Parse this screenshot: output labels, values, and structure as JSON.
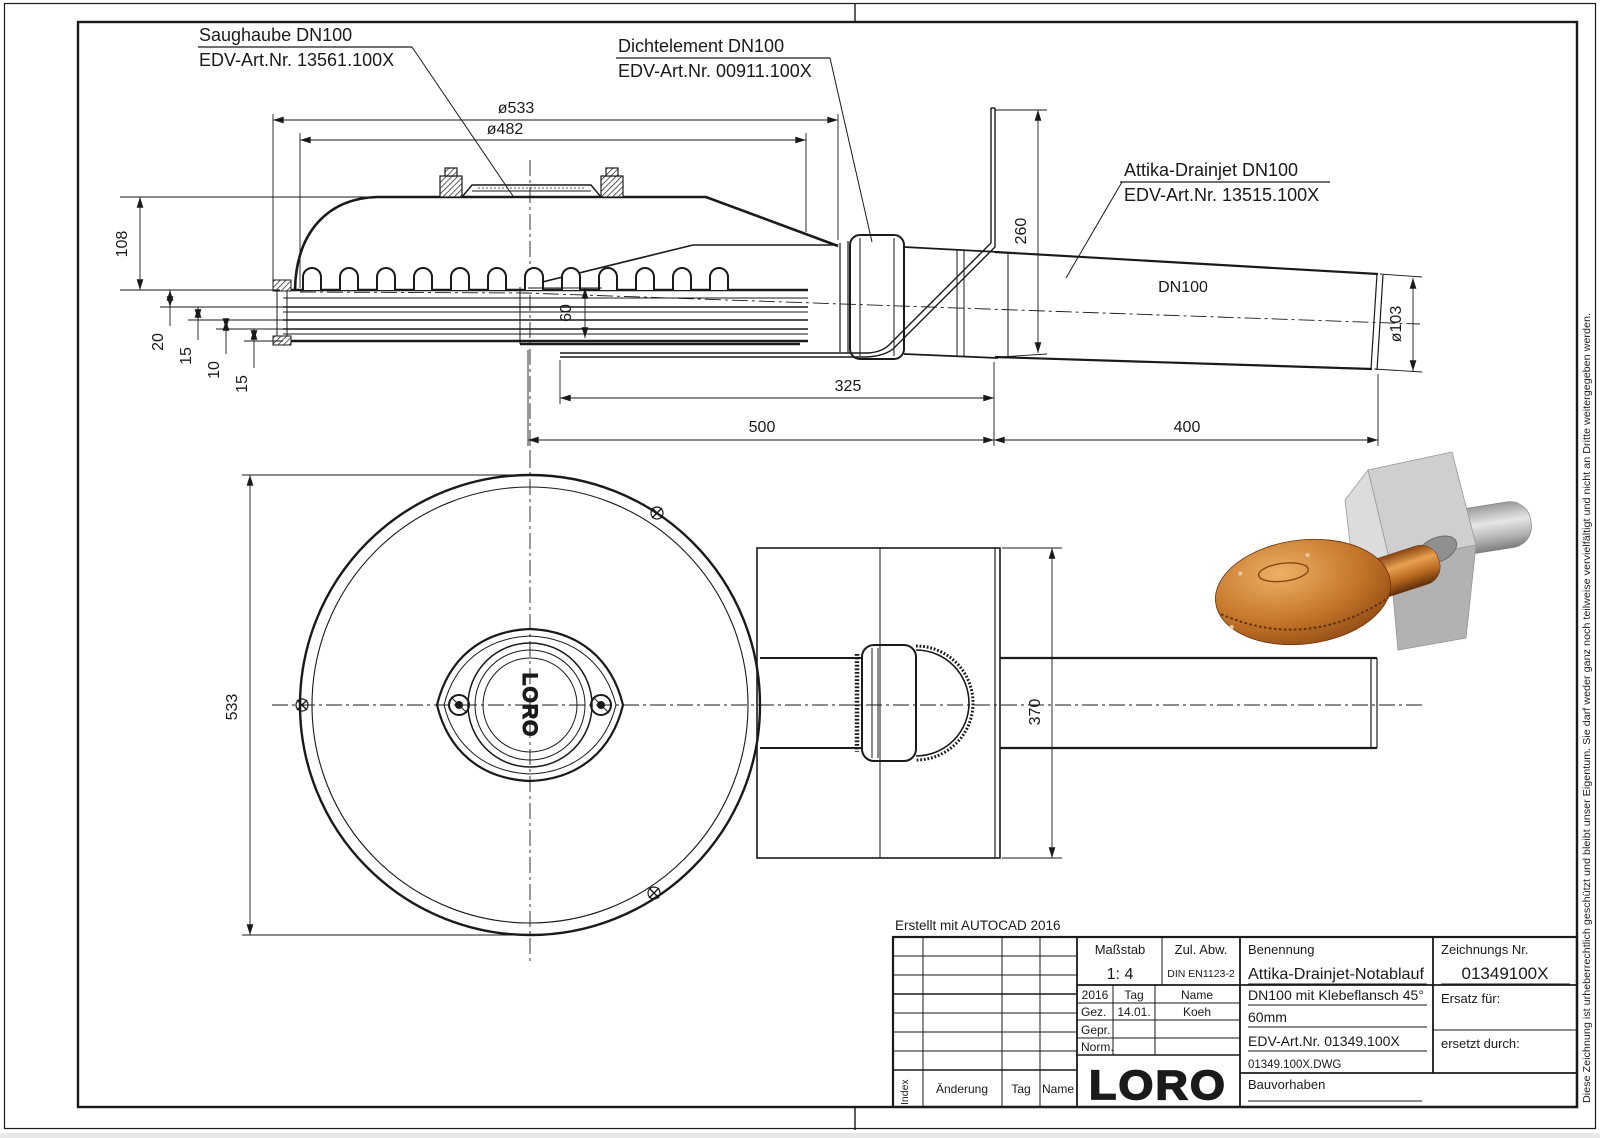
{
  "part_labels": {
    "saughaube": {
      "line1": "Saughaube DN100",
      "line2": "EDV-Art.Nr. 13561.100X"
    },
    "dichtelement": {
      "line1": "Dichtelement DN100",
      "line2": "EDV-Art.Nr. 00911.100X"
    },
    "attika": {
      "line1": "Attika-Drainjet DN100",
      "line2": "EDV-Art.Nr. 13515.100X"
    }
  },
  "side_view": {
    "pipe_label": "DN100",
    "dim_dia_outer": "ø533",
    "dim_dia_inner": "ø482",
    "dim_hood_height": "108",
    "dim_plate_20": "20",
    "dim_plate_15a": "15",
    "dim_plate_10": "10",
    "dim_plate_15b": "15",
    "dim_duct_height": "60",
    "dim_flange_height": "260",
    "dim_len_325": "325",
    "dim_len_500": "500",
    "dim_len_400": "400",
    "dim_pipe_dia": "ø103"
  },
  "plan_view": {
    "dim_dia": "533",
    "dim_plate_height": "370",
    "hub_logo": "LORO"
  },
  "notes": {
    "created_with": "Erstellt mit AUTOCAD 2016",
    "copyright": "Diese Zeichnung ist urheberrechtlich geschützt und bleibt unser Eigentum. Sie darf weder ganz noch teilweise vervielfältigt und nicht an Dritte weitergegeben werden."
  },
  "title_block": {
    "masstab_label": "Maßstab",
    "masstab_value": "1: 4",
    "zul_abw_label": "Zul. Abw.",
    "zul_abw_value": "DIN EN1123-2",
    "benennung_label": "Benennung",
    "benennung_value": "Attika-Drainjet-Notablauf",
    "zeichnungs_nr_label": "Zeichnungs Nr.",
    "zeichnungs_nr_value": "01349100X",
    "approval_year": "2016",
    "approval_col_tag": "Tag",
    "approval_col_name": "Name",
    "gez_label": "Gez.",
    "gez_tag": "14.01.",
    "gez_name": "Koeh",
    "gepr_label": "Gepr.",
    "norm_label": "Norm.",
    "desc_line1": "DN100 mit Klebeflansch 45°",
    "desc_line2": "60mm",
    "desc_line3": "EDV-Art.Nr. 01349.100X",
    "desc_line4": "01349.100X.DWG",
    "ersatz_fuer": "Ersatz für:",
    "ersetzt_durch": "ersetzt durch:",
    "bauvorhaben_label": "Bauvorhaben",
    "logo": "LORO",
    "rev_index": "Index",
    "rev_aenderung": "Änderung",
    "rev_tag": "Tag",
    "rev_name": "Name"
  },
  "render_colors": {
    "copper_light": "#e8a050",
    "copper_mid": "#b5651d",
    "copper_dark": "#7a3d0e",
    "steel_light": "#e2e2e2",
    "steel_mid": "#b8b8b8",
    "steel_dark": "#8a8a8a"
  }
}
